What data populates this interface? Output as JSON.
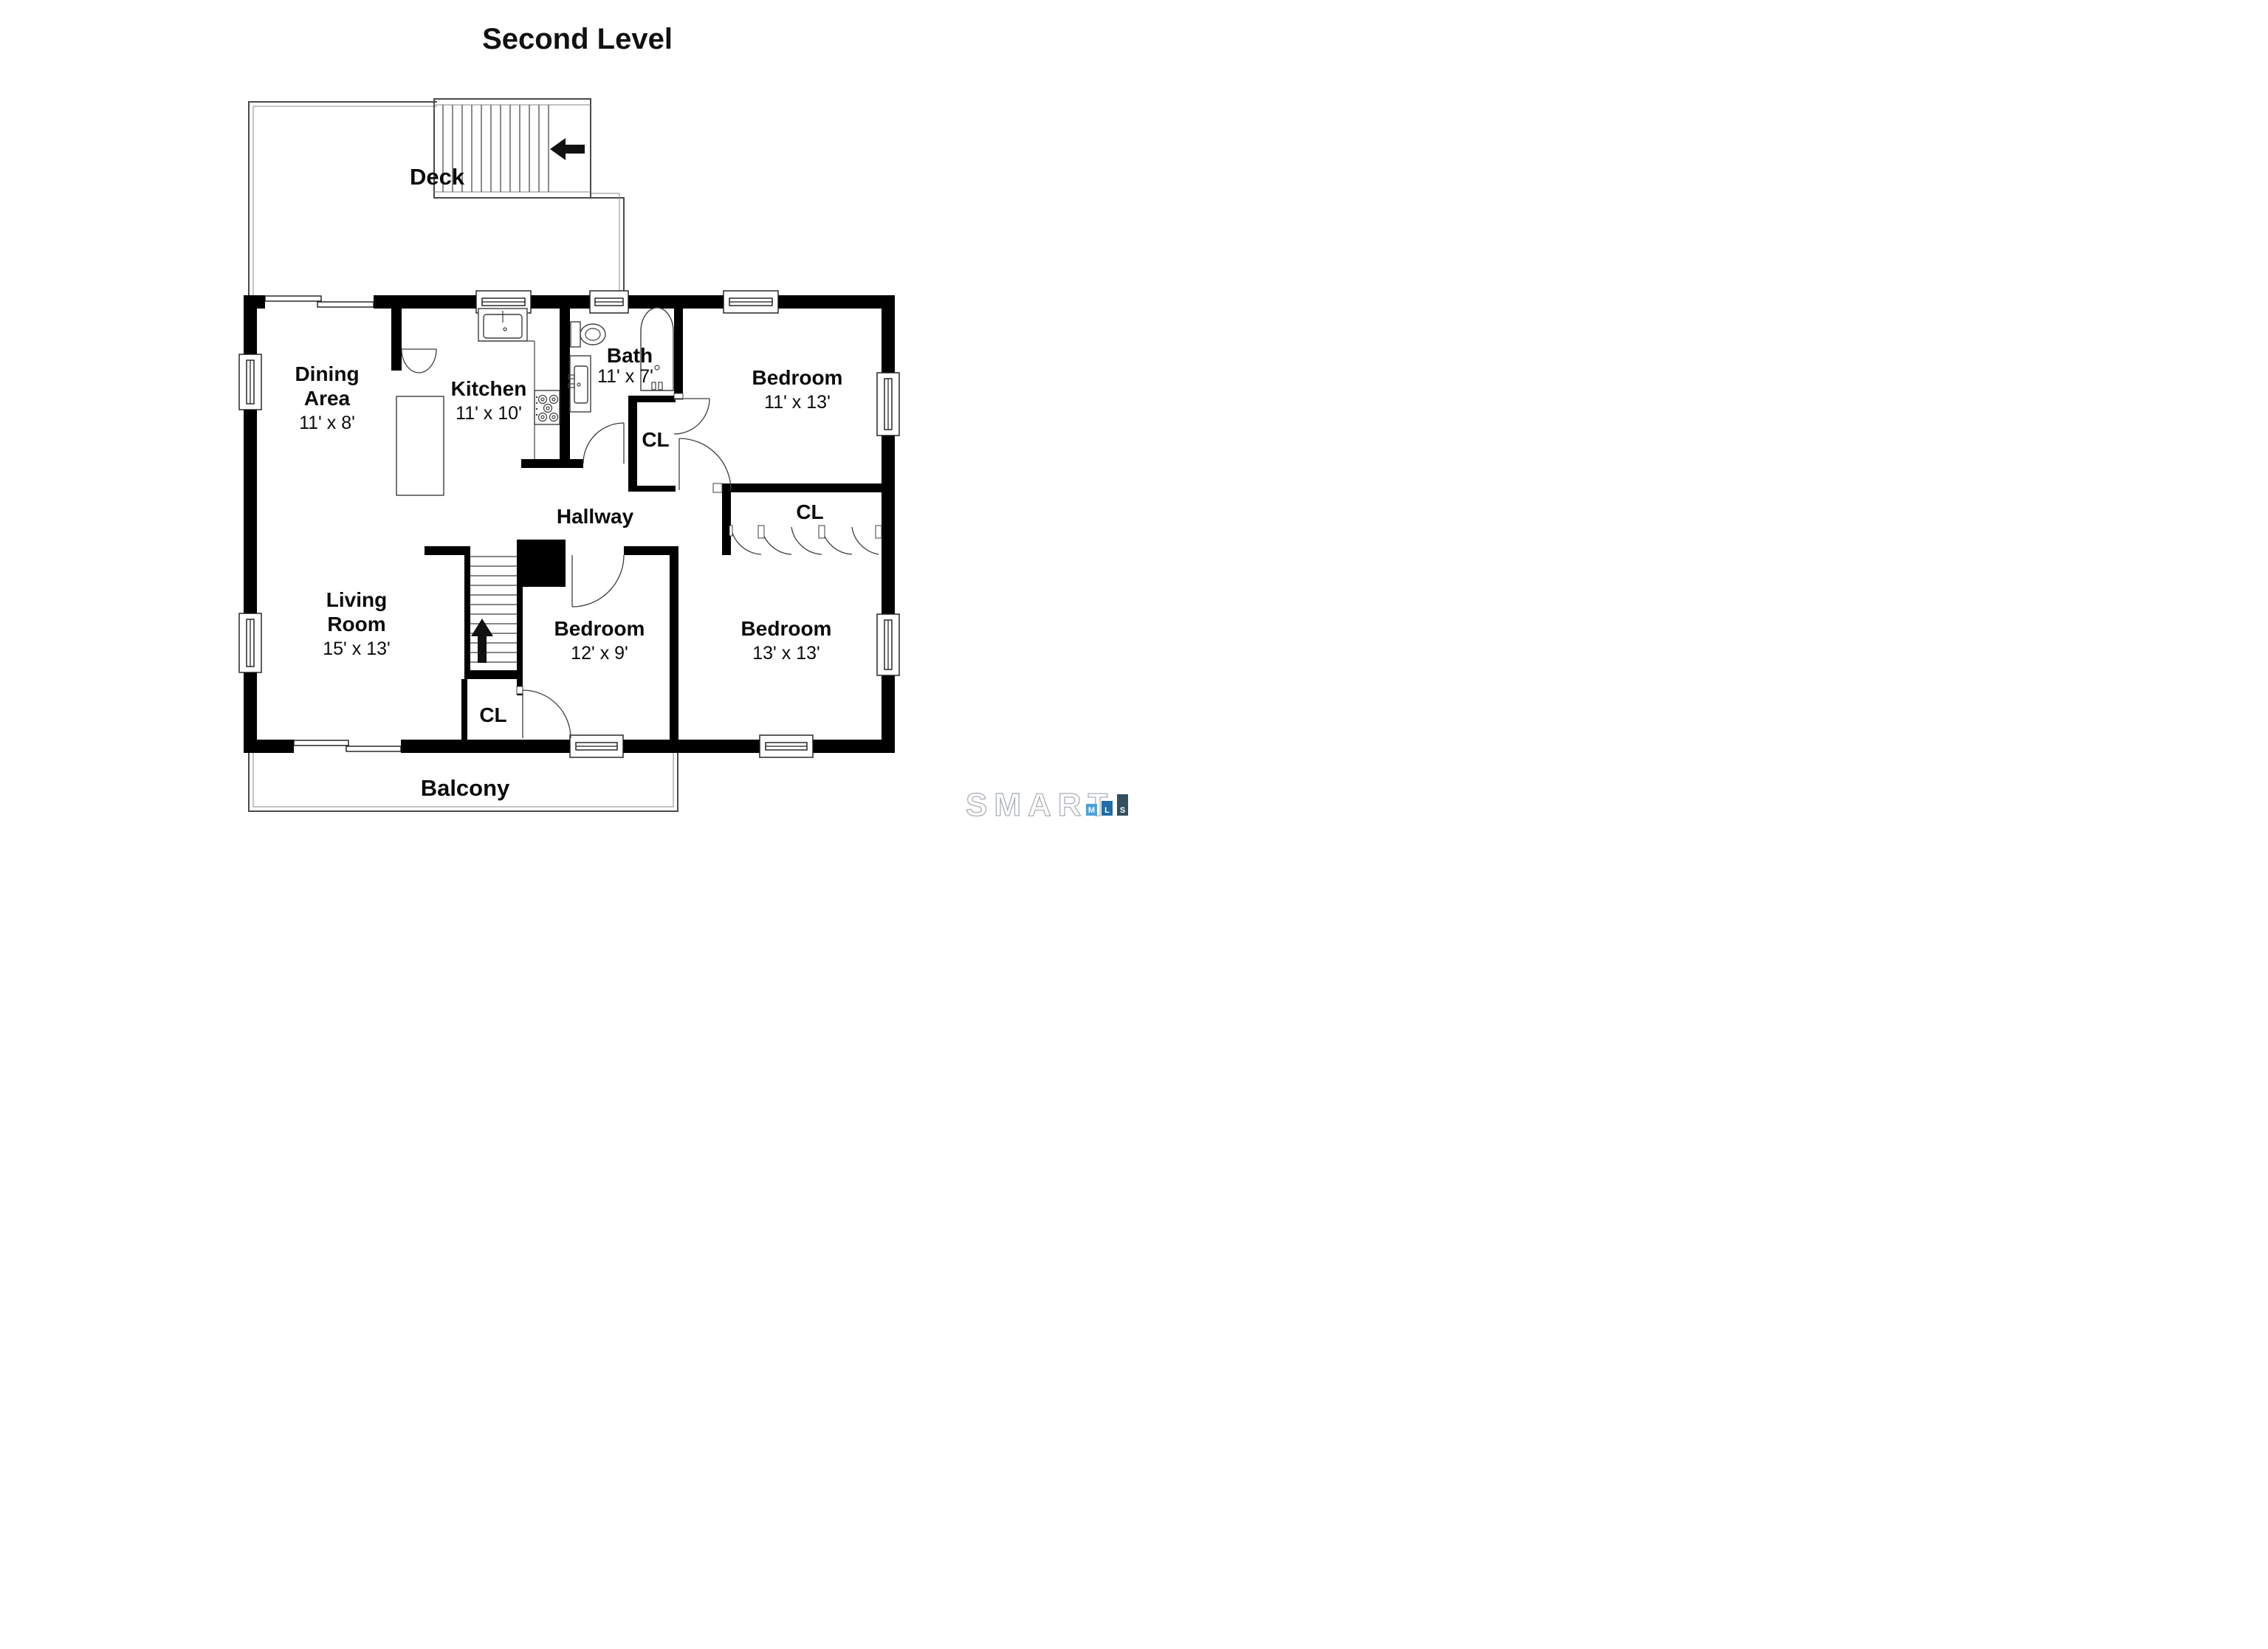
{
  "title": "Second Level",
  "rooms": {
    "deck": {
      "label": "Deck"
    },
    "dining": {
      "line1": "Dining",
      "line2": "Area",
      "dims": "11' x 8'"
    },
    "kitchen": {
      "label": "Kitchen",
      "dims": "11' x 10'"
    },
    "bath": {
      "label": "Bath",
      "dims": "11' x 7'"
    },
    "bedroom_top_right": {
      "label": "Bedroom",
      "dims": "11' x 13'"
    },
    "closet_middle": {
      "label": "CL"
    },
    "hallway": {
      "label": "Hallway"
    },
    "closet_right": {
      "label": "CL"
    },
    "living": {
      "line1": "Living",
      "line2": "Room",
      "dims": "15' x 13'"
    },
    "bedroom_middle": {
      "label": "Bedroom",
      "dims": "12' x 9'"
    },
    "bedroom_bottom_right": {
      "label": "Bedroom",
      "dims": "13' x 13'"
    },
    "closet_lower": {
      "label": "CL"
    },
    "balcony": {
      "label": "Balcony"
    }
  },
  "icons": {
    "deck_stairs_arrow": "left-arrow",
    "interior_stairs_arrow": "up-arrow"
  },
  "colors": {
    "wall": "#000000",
    "outline": "#4a4a4a",
    "logo_m_bar": "#4FA0D8",
    "logo_l_bar": "#1F6CA8",
    "logo_s_bar": "#32505F",
    "logo_text_outline": "#aab0b6"
  },
  "logo": {
    "brand": "SMART",
    "letters": [
      "M",
      "L",
      "S"
    ]
  }
}
